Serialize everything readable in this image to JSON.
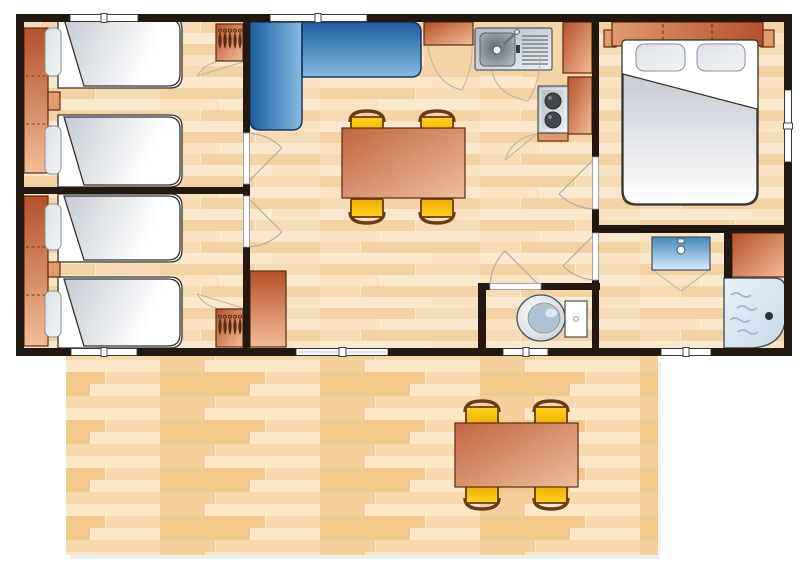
{
  "title": "mobile-home-floor-plan",
  "colors": {
    "wall": "#241911",
    "window": "#ffffff",
    "arc": "#a9a9a9",
    "outline": "#5e2c12",
    "floor_a": "#F3D2A4",
    "floor_b": "#FAE8CE",
    "floor_c": "#F6DCB6",
    "floor_d": "#F9E3C3",
    "deck_a": "#F2C88D",
    "deck_b": "#F7D9AE",
    "deck_c": "#FBE7C8",
    "deck_d": "#F4CF9B",
    "counter": "#F4D4A6",
    "furniture_dark": "#B4512A",
    "furniture_light": "#F3BC97",
    "orange_mid": "#E09A6C",
    "table_dark": "#C0663E",
    "table_light": "#EFBD9E",
    "chair_yellow": "#FFD21E",
    "chair_yellow_dark": "#EDAD00",
    "chair_frame": "#6B3A16",
    "sofa_dark": "#1D5C9F",
    "sofa_light": "#85BCE2",
    "sofa_outline": "#143A60",
    "duvet_grey": "#C5CBD4",
    "pillow_light": "#F2F4F7",
    "pillow_dark": "#DDE1E6",
    "metal_dark": "#AEB8BE",
    "metal_light": "#EFF2F4",
    "burner": "#41474D",
    "basin_top": "#4189BE",
    "basin_bottom": "#D8ECF8",
    "shower_fill": "#E7F0F8",
    "shower_deep": "#C9DAEA",
    "shower_wave": "#9FB8CF",
    "toilet_inner": "#AEC3D1",
    "hanger": "#5C2D12"
  },
  "furniture": {
    "single_beds": 4,
    "double_beds": 1,
    "twin_bedrooms": 2,
    "wardrobes": 2,
    "hanging_closets": 2,
    "nightstands": 2,
    "sofa": "l-shaped-corner",
    "dining_tables": 2,
    "chairs_per_table": 4,
    "kitchen_items": [
      "sink-with-drainer",
      "two-burner-stove",
      "cabinets",
      "worktop"
    ],
    "bathroom_items": [
      "washbasin",
      "corner-cabinet",
      "shower"
    ],
    "wc_items": [
      "toilet"
    ],
    "outdoor": [
      "deck-terrace",
      "picnic-table",
      "chairs"
    ]
  },
  "openings": {
    "windows": 7,
    "interior_doors": 5
  }
}
